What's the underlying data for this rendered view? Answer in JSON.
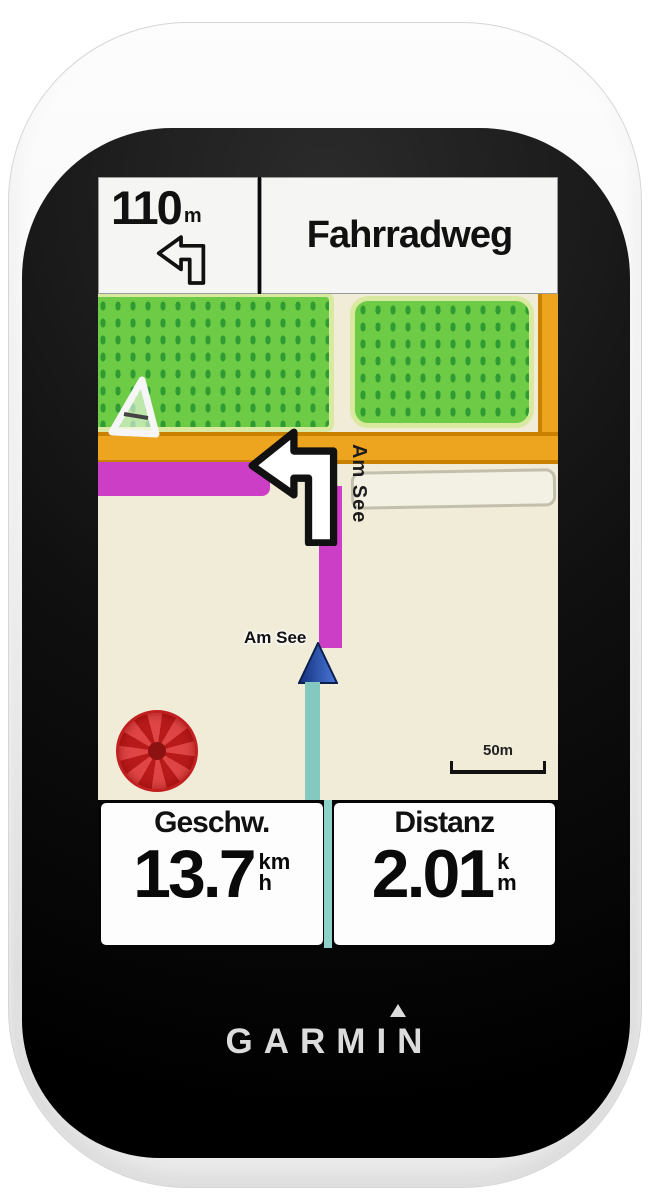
{
  "brand": {
    "logo_text": "GARMIN"
  },
  "screen": {
    "banner": {
      "distance_value": "110",
      "distance_unit": "m",
      "street_name": "Fahrradweg",
      "turn_direction": "left"
    },
    "map": {
      "street_label": "Am See",
      "position_label": "Am See",
      "scale_label": "50m",
      "colors": {
        "land_cream": "#f0ecd8",
        "park_green": "#6ecb46",
        "park_dot_green": "#2f9b33",
        "road_orange": "#eda41e",
        "route_magenta": "#cd3ec6",
        "track_teal": "#84c9c0",
        "poi_red": "#c21d1d",
        "marker_blue": "#14317e"
      }
    },
    "data_fields": [
      {
        "label": "Geschw.",
        "value": "13.7",
        "unit_top": "km",
        "unit_bottom": "h"
      },
      {
        "label": "Distanz",
        "value": "2.01",
        "unit_top": "k",
        "unit_bottom": "m"
      }
    ]
  }
}
